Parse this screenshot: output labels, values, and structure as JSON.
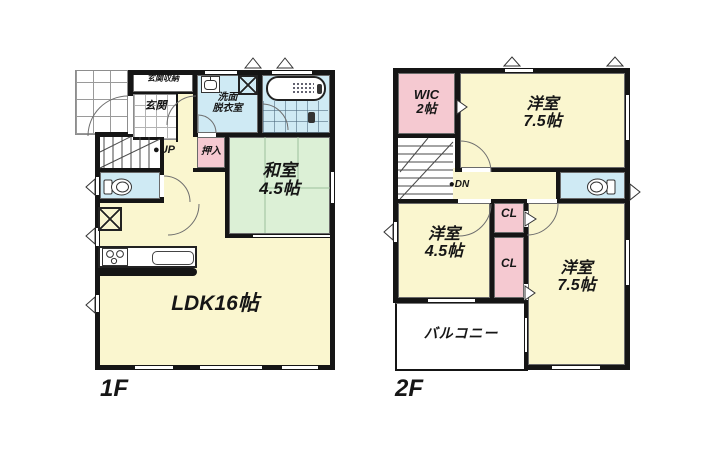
{
  "palette": {
    "wall": "#151515",
    "room_yellow": "#faf6cf",
    "room_green": "#dcf0d6",
    "room_pink": "#f5c9d1",
    "room_blue": "#cfeaf4",
    "background": "#ffffff"
  },
  "floor1": {
    "floor_label": "1F",
    "genkan_storage": "玄関収納",
    "genkan": "玄関",
    "washroom_line1": "洗面",
    "washroom_line2": "脱衣室",
    "stairs_marker": "●",
    "stairs_label": "UP",
    "oshiire": "押入",
    "washitsu_line1": "和室",
    "washitsu_line2": "4.5帖",
    "ldk": "LDK16帖"
  },
  "floor2": {
    "floor_label": "2F",
    "wic_line1": "WIC",
    "wic_line2": "2帖",
    "bedroom_top_line1": "洋室",
    "bedroom_top_line2": "7.5帖",
    "stairs_marker": "●",
    "stairs_label": "DN",
    "closet_top": "CL",
    "closet_bottom": "CL",
    "bedroom_left_line1": "洋室",
    "bedroom_left_line2": "4.5帖",
    "bedroom_right_line1": "洋室",
    "bedroom_right_line2": "7.5帖",
    "balcony": "バルコニー"
  }
}
